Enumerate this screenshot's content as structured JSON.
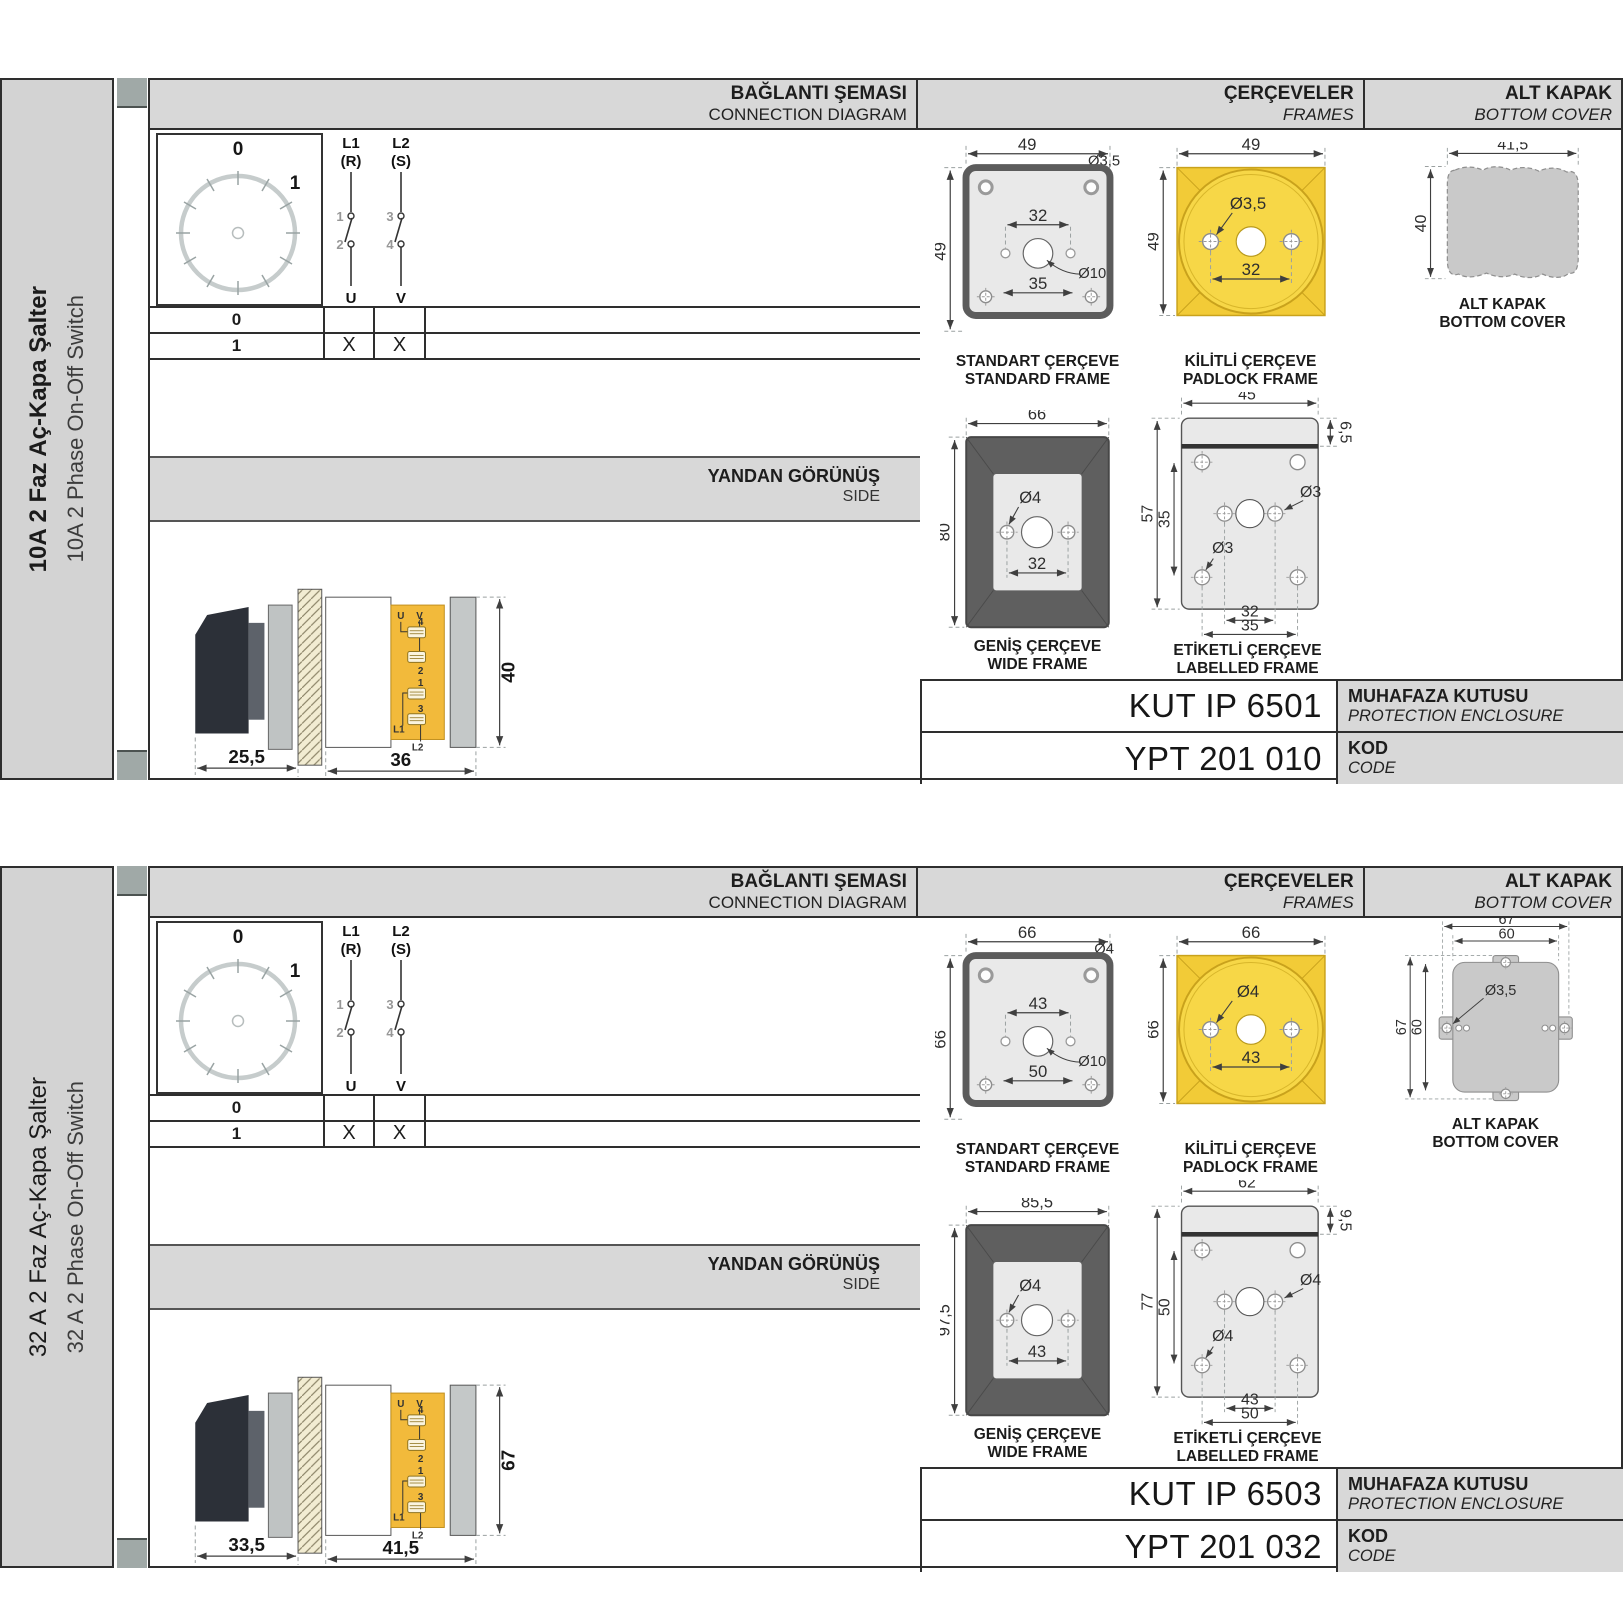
{
  "sections": [
    {
      "label": {
        "tr": "10A 2 Faz Aç-Kapa Şalter",
        "en": "10A 2 Phase On-Off Switch"
      },
      "headers": {
        "conn_tr": "BAĞLANTI ŞEMASI",
        "conn_en": "CONNECTION DIAGRAM",
        "frames_tr": "ÇERÇEVELER",
        "frames_en": "FRAMES",
        "cover_tr": "ALT KAPAK",
        "cover_en": "BOTTOM COVER"
      },
      "dial": {
        "p0": "0",
        "p1": "1"
      },
      "conn": {
        "l1": "L1",
        "r": "(R)",
        "l2": "L2",
        "s": "(S)",
        "n1": "1",
        "n2": "2",
        "n3": "3",
        "n4": "4",
        "u": "U",
        "v": "V"
      },
      "table": {
        "r0": {
          "pos": "0",
          "u": "",
          "v": ""
        },
        "r1": {
          "pos": "1",
          "u": "X",
          "v": "X"
        }
      },
      "side": {
        "tr": "YANDAN GÖRÜNÜŞ",
        "en": "SIDE",
        "u": "U",
        "v": "V",
        "n4": "4",
        "n2": "2",
        "n1": "1",
        "n3": "3",
        "l1": "L1",
        "l2": "L2",
        "d_front": "25,5",
        "d_body": "36",
        "d_h": "40"
      },
      "fr_std": {
        "w": "49",
        "h": "49",
        "hole": "Ø3,5",
        "span_in": "32",
        "center": "Ø10",
        "span_lo": "35",
        "cap_tr": "STANDART ÇERÇEVE",
        "cap_en": "STANDARD FRAME"
      },
      "fr_pad": {
        "w": "49",
        "h": "49",
        "hole": "Ø3,5",
        "span": "32",
        "cap_tr": "KİLİTLİ ÇERÇEVE",
        "cap_en": "PADLOCK FRAME"
      },
      "fr_wide": {
        "w": "66",
        "h": "80",
        "hole": "Ø4",
        "span": "32",
        "cap_tr": "GENİŞ ÇERÇEVE",
        "cap_en": "WIDE FRAME"
      },
      "fr_lab": {
        "w": "45",
        "strip": "6,5",
        "h": "57",
        "h_in": "35",
        "hole_a": "Ø3",
        "hole_b": "Ø3",
        "span_a": "32",
        "span_b": "35",
        "cap_tr": "ETİKETLİ ÇERÇEVE",
        "cap_en": "LABELLED FRAME"
      },
      "cover": {
        "w": "41,5",
        "h": "40",
        "cap_tr": "ALT KAPAK",
        "cap_en": "BOTTOM COVER"
      },
      "enc": {
        "code": "KUT IP 6501",
        "tr": "MUHAFAZA KUTUSU",
        "en": "PROTECTION ENCLOSURE"
      },
      "kod": {
        "code": "YPT 201 010",
        "tr": "KOD",
        "en": "CODE"
      }
    },
    {
      "label": {
        "tr": "32 A 2 Faz Aç-Kapa Şalter",
        "en": "32 A 2 Phase On-Off Switch"
      },
      "headers": {
        "conn_tr": "BAĞLANTI ŞEMASI",
        "conn_en": "CONNECTION DIAGRAM",
        "frames_tr": "ÇERÇEVELER",
        "frames_en": "FRAMES",
        "cover_tr": "ALT KAPAK",
        "cover_en": "BOTTOM COVER"
      },
      "dial": {
        "p0": "0",
        "p1": "1"
      },
      "conn": {
        "l1": "L1",
        "r": "(R)",
        "l2": "L2",
        "s": "(S)",
        "n1": "1",
        "n2": "2",
        "n3": "3",
        "n4": "4",
        "u": "U",
        "v": "V"
      },
      "table": {
        "r0": {
          "pos": "0",
          "u": "",
          "v": ""
        },
        "r1": {
          "pos": "1",
          "u": "X",
          "v": "X"
        }
      },
      "side": {
        "tr": "YANDAN GÖRÜNÜŞ",
        "en": "SIDE",
        "u": "U",
        "v": "V",
        "n4": "4",
        "n2": "2",
        "n1": "1",
        "n3": "3",
        "l1": "L1",
        "l2": "L2",
        "d_front": "33,5",
        "d_body": "41,5",
        "d_h": "67"
      },
      "fr_std": {
        "w": "66",
        "h": "66",
        "hole": "Ø4",
        "span_in": "43",
        "center": "Ø10",
        "span_lo": "50",
        "cap_tr": "STANDART ÇERÇEVE",
        "cap_en": "STANDARD FRAME"
      },
      "fr_pad": {
        "w": "66",
        "h": "66",
        "hole": "Ø4",
        "span": "43",
        "cap_tr": "KİLİTLİ ÇERÇEVE",
        "cap_en": "PADLOCK FRAME"
      },
      "fr_wide": {
        "w": "85,5",
        "h": "97,5",
        "hole": "Ø4",
        "span": "43",
        "cap_tr": "GENİŞ ÇERÇEVE",
        "cap_en": "WIDE FRAME"
      },
      "fr_lab": {
        "w": "62",
        "strip": "9,5",
        "h": "77",
        "h_in": "50",
        "hole_a": "Ø4",
        "hole_b": "Ø4",
        "span_a": "43",
        "span_b": "50",
        "cap_tr": "ETİKETLİ ÇERÇEVE",
        "cap_en": "LABELLED FRAME"
      },
      "cover": {
        "w_out": "67",
        "w_in": "60",
        "hole": "Ø3,5",
        "h_out": "67",
        "h_in": "60",
        "cap_tr": "ALT KAPAK",
        "cap_en": "BOTTOM COVER"
      },
      "enc": {
        "code": "KUT IP 6503",
        "tr": "MUHAFAZA KUTUSU",
        "en": "PROTECTION ENCLOSURE"
      },
      "kod": {
        "code": "YPT 201 032",
        "tr": "KOD",
        "en": "CODE"
      }
    }
  ]
}
